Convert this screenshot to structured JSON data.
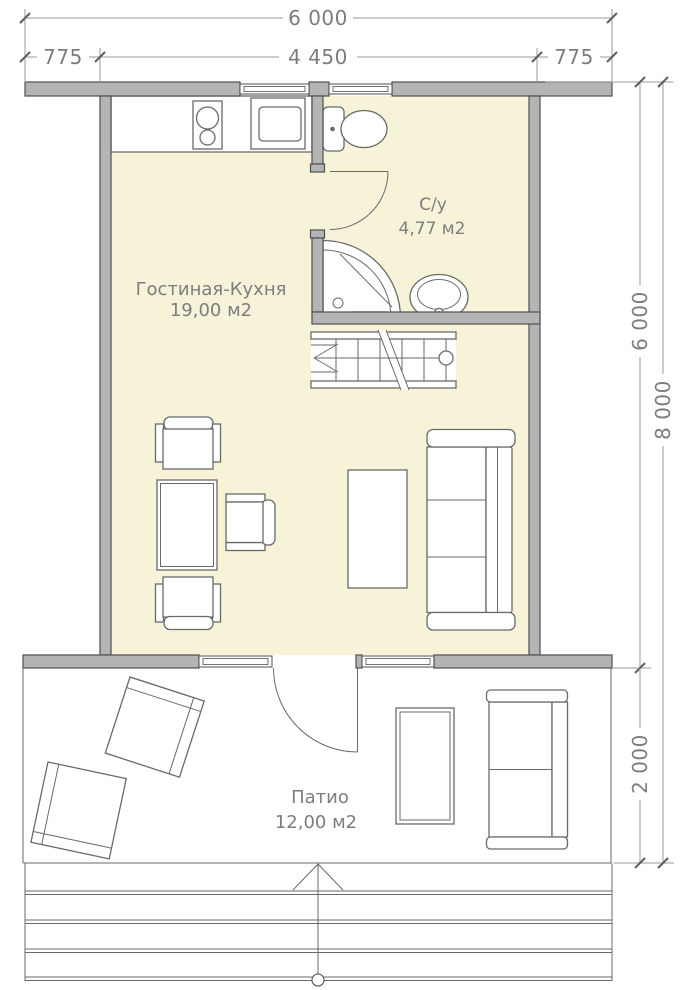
{
  "plan": {
    "dimensions": {
      "top_total": "6 000",
      "top_left": "775",
      "top_middle": "4 450",
      "top_right": "775",
      "right_house": "6 000",
      "right_total": "8 000",
      "right_patio": "2 000"
    },
    "rooms": {
      "living_kitchen": {
        "name": "Гостиная-Кухня",
        "area": "19,00 м2"
      },
      "bathroom": {
        "name": "С/у",
        "area": "4,77 м2"
      },
      "patio": {
        "name": "Патио",
        "area": "12,00 м2"
      }
    },
    "colors": {
      "background": "#ffffff",
      "wall_fill": "#b4b4b4",
      "wall_stroke": "#4f4f4f",
      "floor_fill": "#f6f3d9",
      "line": "#6a6a6a",
      "dim": "#9a9a9a",
      "text": "#7d7d7d"
    }
  }
}
